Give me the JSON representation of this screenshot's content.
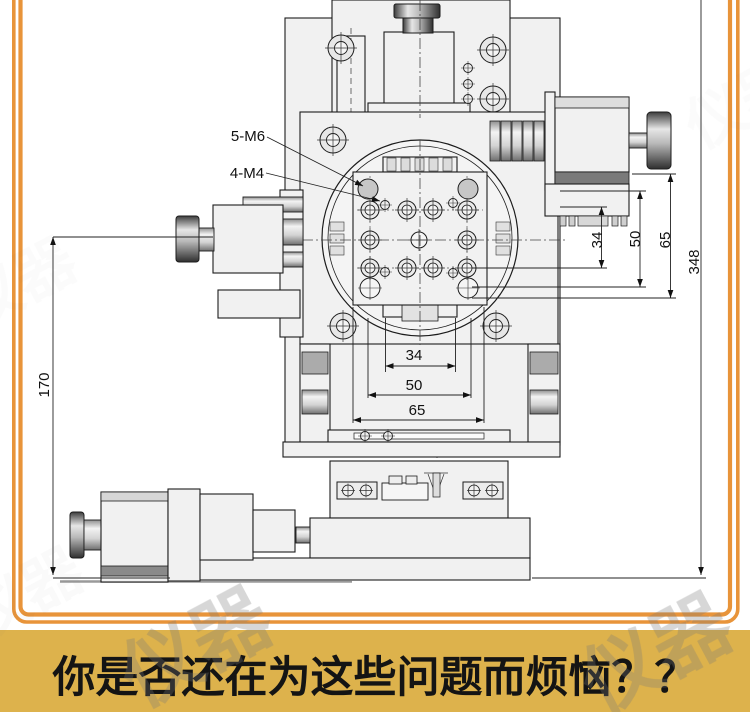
{
  "frame": {
    "border_color": "#e8943a",
    "background": "#ffffff"
  },
  "banner": {
    "text": "你是否还在为这些问题而烦恼？？",
    "bg_color": "#ddb24c",
    "text_color": "#141414"
  },
  "watermark": {
    "text": "仪器"
  },
  "drawing": {
    "type": "technical-dimension-drawing",
    "subject": "multi-axis precision stage front view with rotary table and micrometer heads",
    "labels": {
      "thread_5m6": "5-M6",
      "thread_4m4": "4-M4"
    },
    "dimensions": {
      "bottom_horizontal": [
        {
          "value": "34"
        },
        {
          "value": "50"
        },
        {
          "value": "65"
        }
      ],
      "right_vertical": [
        {
          "value": "34"
        },
        {
          "value": "50"
        },
        {
          "value": "65"
        },
        {
          "value": "348"
        }
      ],
      "left_vertical": [
        {
          "value": "170"
        }
      ]
    }
  }
}
